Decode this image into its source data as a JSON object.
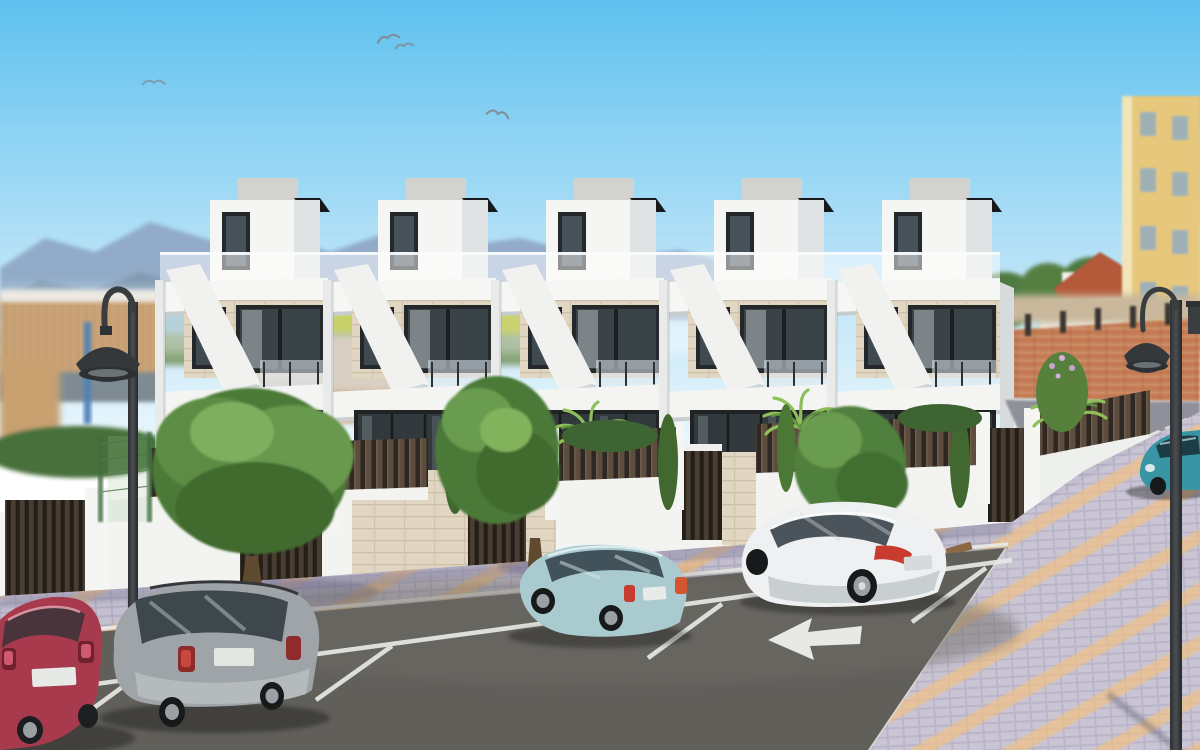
{
  "scene": {
    "type": "architectural-3d-render",
    "description": "Row of five modern white three-storey townhouses with roof terraces and glass balustrades, dark timber slat privacy fence with gates, street parking with parked cars, gooseneck street lamps, mountains and clear blue sky with birds",
    "time_of_day": "day",
    "bird_count": 4
  },
  "palette": {
    "sky_top": "#5ec1ef",
    "sky_mid": "#b5e1f7",
    "sky_horizon": "#eef8fd",
    "mountain_far": "#8ea6c4",
    "mountain_near": "#7e98ae",
    "hill_green": "#74945f",
    "field_yellow": "#cdd45e",
    "house_white": "#f5f5f3",
    "house_shade": "#e0e3e3",
    "stone_beige": "#ddd4c6",
    "glass_dark": "#3a4347",
    "frame_dark": "#24282a",
    "fence_slat": "#5d4d3e",
    "fence_gap": "#2f2721",
    "wall_white": "#f3f4f1",
    "tile_beige": "#e0d6c2",
    "pavement_base": "#b3adc2",
    "pavement_cell": "#c4bfd0",
    "pavement_stripe": "#ecba7c",
    "road": "#615f5a",
    "marking_white": "#e8e9e5",
    "lamp_dark": "#3a3d3f",
    "brick": "#c47a52",
    "building_yellow": "#e6c77c",
    "roof_red": "#b45a3a",
    "tree_green": "#4c7a38",
    "palm_green": "#8fbe5a",
    "taillight_red": "#c83c30"
  },
  "buildings": {
    "townhouse_count": 5,
    "storeys": 3,
    "features": [
      "penthouse roof box",
      "glass roof balustrade",
      "diagonal white balcony parapet",
      "floor-to-ceiling dark framed windows",
      "stone tile accents"
    ],
    "background": [
      "yellow apartment block",
      "white house with red tile roof",
      "timber slat building",
      "orange brick boundary wall"
    ]
  },
  "street": {
    "parking_stall_dividers": 5,
    "road_arrow_direction": "left",
    "sidewalk_style": "lavender pavers with diagonal orange stripes",
    "crosswalk": true,
    "street_lamp_count": 2,
    "street_lamp_style": "gooseneck"
  },
  "cars": [
    {
      "name": "red-hatchback",
      "color": "#a83a4e",
      "position": "far left, partially cropped"
    },
    {
      "name": "silver-suv",
      "color": "#9ea4a8",
      "position": "left stall"
    },
    {
      "name": "light-teal-sedan",
      "color": "#a9cbd0",
      "position": "center stall"
    },
    {
      "name": "white-crossover",
      "color": "#eef0f1",
      "position": "right stall"
    },
    {
      "name": "teal-coupe",
      "color": "#3895a3",
      "position": "far right side street"
    }
  ],
  "vegetation": {
    "street_trees": 3,
    "cypresses": 5,
    "palm_clusters": 4,
    "corner_bush_flowers": true
  }
}
